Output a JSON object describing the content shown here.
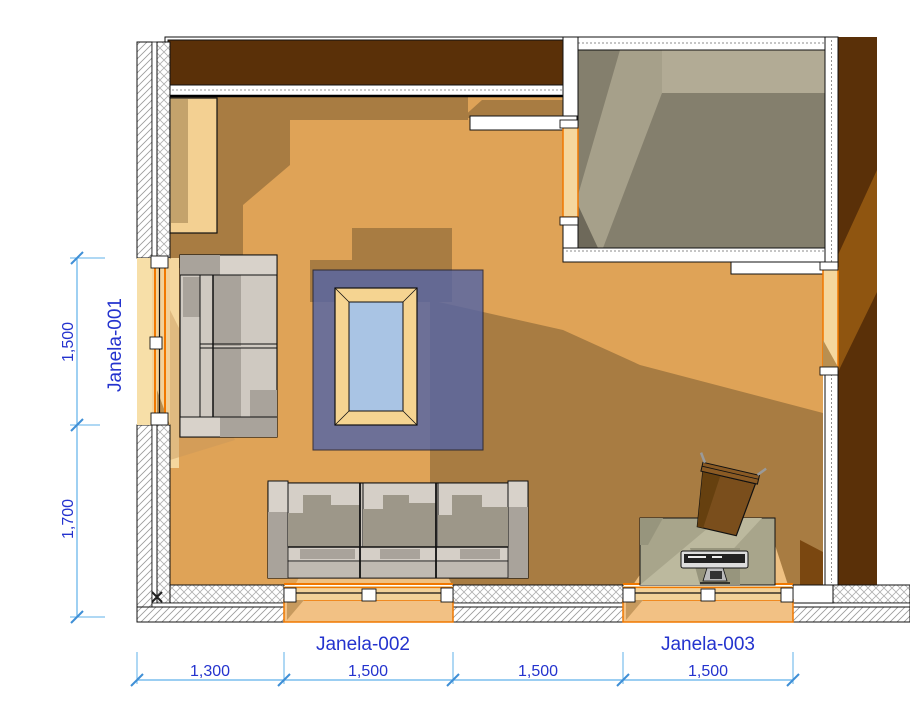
{
  "drawing": {
    "title": "floor-plan-view",
    "window_labels": {
      "janela_001": "Janela-001",
      "janela_002": "Janela-002",
      "janela_003": "Janela-003"
    },
    "dimensions": {
      "vertical": {
        "segments": [
          {
            "value": "1,500"
          },
          {
            "value": "1,700"
          }
        ]
      },
      "horizontal": {
        "segments": [
          {
            "value": "1,300"
          },
          {
            "value": "1,500"
          },
          {
            "value": "1,500"
          },
          {
            "value": "1,500"
          }
        ]
      }
    },
    "colors": {
      "window_accent_orange": "#F07800",
      "dimension_line_blue": "#5FB0EA",
      "dimension_text_blue": "#2433CE",
      "wall_fill_brown": "#5A3008",
      "floor_orange": "#DFA357",
      "floor_shadow": "#A87C42",
      "rug_blue": "#5766A4",
      "adjacent_floor_gray": "#847F6D",
      "table_glass_blue": "#A9C4E4"
    }
  }
}
